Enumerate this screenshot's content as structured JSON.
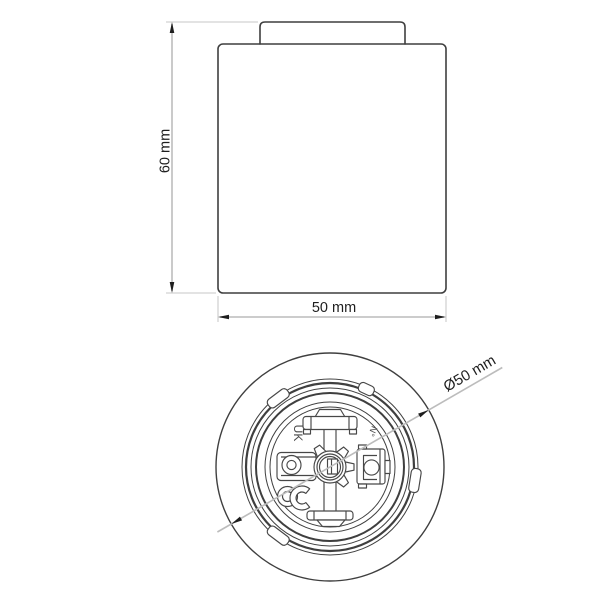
{
  "page": {
    "background_color": "#ffffff",
    "line_color": "#3f3f3f",
    "dimension_line_color": "#bcbcbc",
    "text_color": "#1e1e1e"
  },
  "side_view": {
    "height_label": "60 mm",
    "width_label": "50 mm"
  },
  "bottom_view": {
    "diameter_label": "Ø50 mm",
    "markings": {
      "uk": "UK",
      "number": "N°"
    }
  }
}
